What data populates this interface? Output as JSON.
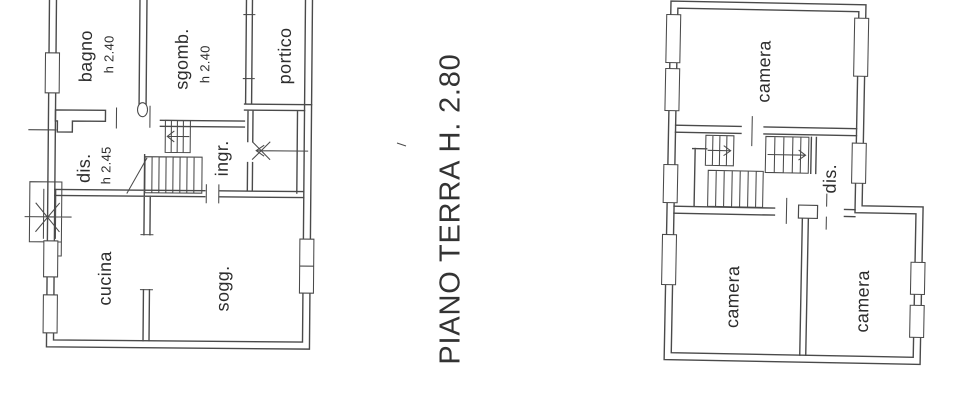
{
  "colors": {
    "ink": "#4a4a4a",
    "text": "#2d2d2d",
    "paper": "#ffffff"
  },
  "title": {
    "label": "PIANO TERRA H. 2.80"
  },
  "left_plan": {
    "rooms": {
      "bagno": {
        "label": "bagno",
        "height": "h 2.40"
      },
      "sgombero": {
        "label": "sgomb.",
        "height": "h 2.40"
      },
      "portico": {
        "label": "portico"
      },
      "disimpegno": {
        "label": "dis.",
        "height": "h 2.45"
      },
      "ingresso": {
        "label": "ingr."
      },
      "cucina": {
        "label": "cucina"
      },
      "soggiorno": {
        "label": "sogg."
      }
    }
  },
  "right_plan": {
    "rooms": {
      "camera_nord": {
        "label": "camera"
      },
      "disimpegno": {
        "label": "dis."
      },
      "camera_sud_ovest": {
        "label": "camera"
      },
      "camera_sud_est": {
        "label": "camera"
      }
    }
  }
}
